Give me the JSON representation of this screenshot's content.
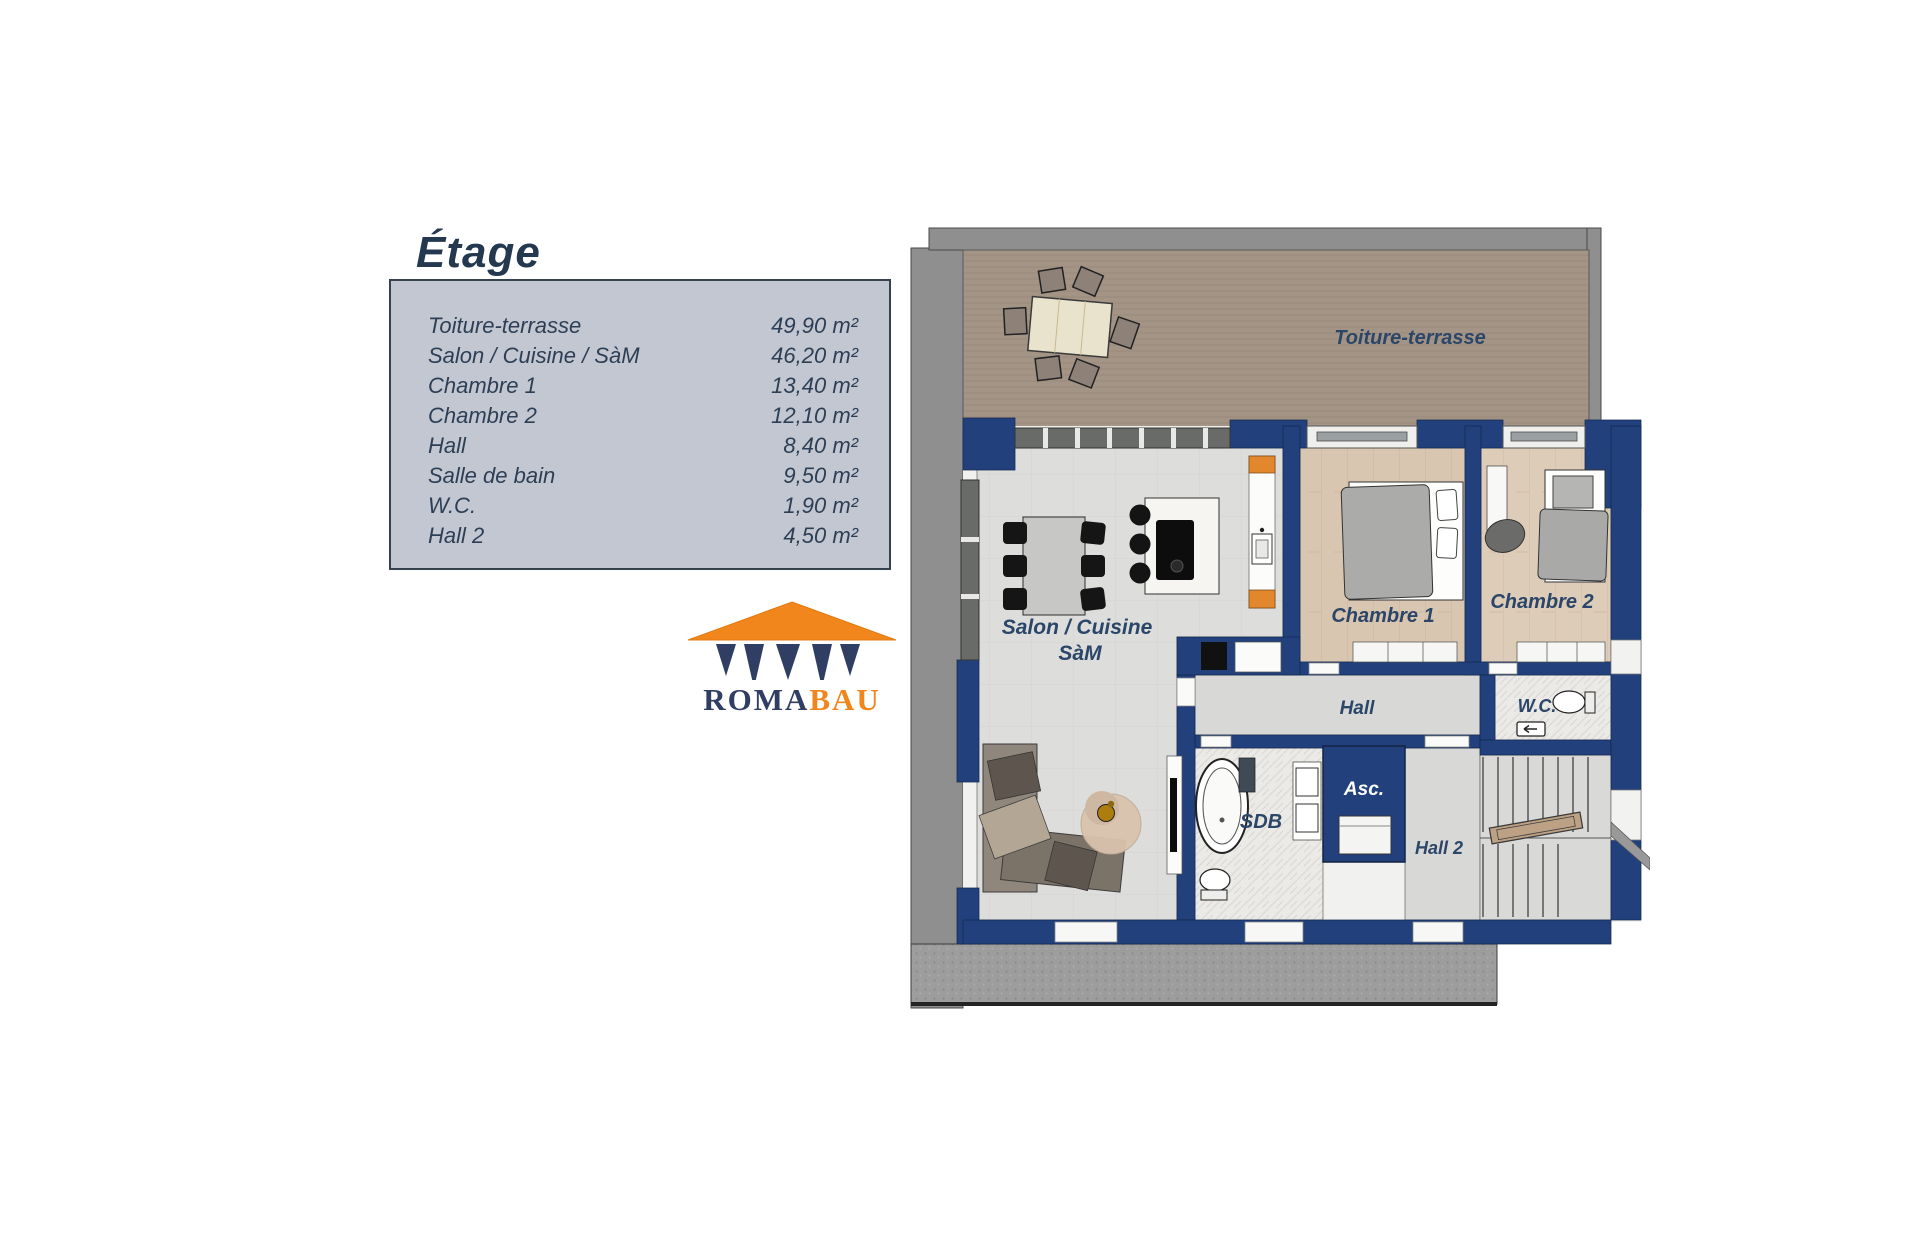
{
  "legend": {
    "title": "Étage",
    "rows": [
      {
        "label": "Toiture-terrasse",
        "area": "49,90 m²"
      },
      {
        "label": "Salon / Cuisine / SàM",
        "area": "46,20 m²"
      },
      {
        "label": "Chambre 1",
        "area": "13,40 m²"
      },
      {
        "label": "Chambre 2",
        "area": "12,10 m²"
      },
      {
        "label": "Hall",
        "area": "8,40 m²"
      },
      {
        "label": "Salle de bain",
        "area": "9,50 m²"
      },
      {
        "label": "W.C.",
        "area": "1,90 m²"
      },
      {
        "label": "Hall 2",
        "area": "4,50 m²"
      }
    ]
  },
  "logo": {
    "name": "ROMABAU",
    "text_primary": "ROMA",
    "text_secondary": "BAU"
  },
  "plan": {
    "labels": {
      "toiture_terrasse": "Toiture-terrasse",
      "salon_line1": "Salon / Cuisine",
      "salon_line2": "SàM",
      "chambre1": "Chambre 1",
      "chambre2": "Chambre 2",
      "hall": "Hall",
      "wc": "W.C.",
      "sdb": "SDB",
      "asc": "Asc.",
      "hall2": "Hall 2"
    },
    "colors": {
      "wall_navy": "#21407c",
      "label_text": "#2b4668",
      "terrace_deck": "#a39486",
      "wood_floor_1": "#d9c6b0",
      "wood_floor_2": "#ddccb8",
      "salon_floor": "#dddddb",
      "hall_floor": "#d8d8d6",
      "bath_floor": "#eceae6",
      "exterior_gray": "#8f8f8f",
      "lower_terrace_gray": "#9d9d9d",
      "orange_accent": "#e2872e",
      "asc_text": "#ffffff"
    }
  }
}
